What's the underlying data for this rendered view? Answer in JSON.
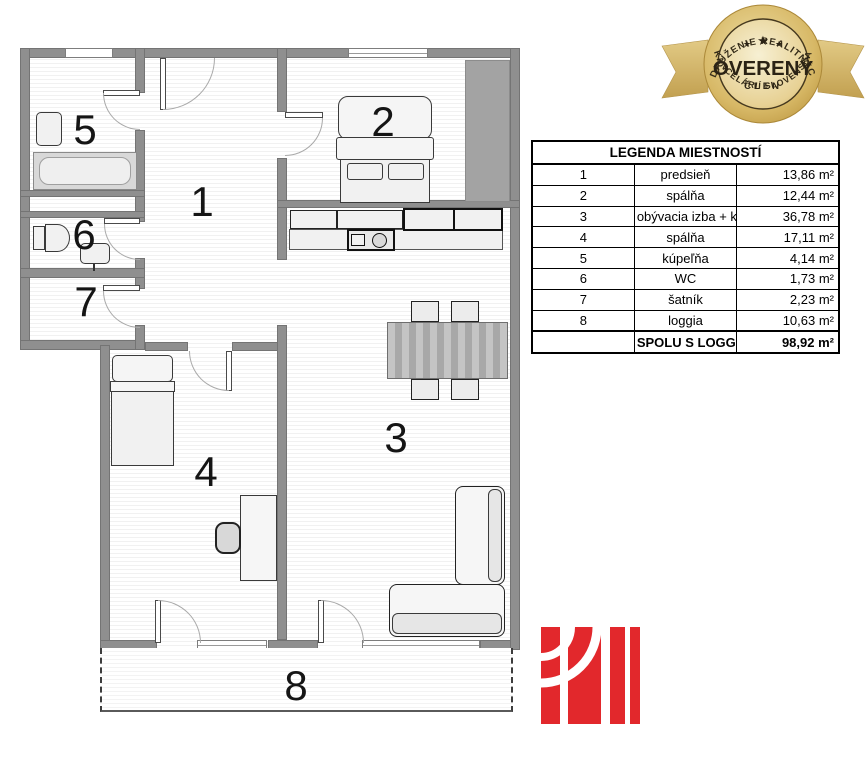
{
  "plan": {
    "rooms": [
      {
        "label": "1"
      },
      {
        "label": "2"
      },
      {
        "label": "3"
      },
      {
        "label": "4"
      },
      {
        "label": "5"
      },
      {
        "label": "6"
      },
      {
        "label": "7"
      },
      {
        "label": "8"
      }
    ]
  },
  "legend": {
    "title": "LEGENDA MIESTNOSTÍ",
    "rows": [
      {
        "num": "1",
        "name": "predsieň",
        "area": "13,86 m²"
      },
      {
        "num": "2",
        "name": "spálňa",
        "area": "12,44 m²"
      },
      {
        "num": "3",
        "name": "obývacia izba + kuchyňa",
        "area": "36,78 m²"
      },
      {
        "num": "4",
        "name": "spálňa",
        "area": "17,11 m²"
      },
      {
        "num": "5",
        "name": "kúpeľňa",
        "area": "4,14 m²"
      },
      {
        "num": "6",
        "name": "WC",
        "area": "1,73 m²"
      },
      {
        "num": "7",
        "name": "šatník",
        "area": "2,23 m²"
      },
      {
        "num": "8",
        "name": "loggia",
        "area": "10,63 m²"
      }
    ],
    "total_label": "SPOLU S LOGGIOU",
    "total_area": "98,92 m²"
  },
  "badge": {
    "arc_top": "ZDRUŽENIE REALITNÝCH",
    "arc_bottom": "KANCELÁRIÍ SLOVENSKA",
    "title": "OVERENÝ",
    "subtitle": "ČLEN",
    "star": "★"
  },
  "colors": {
    "accent_red": "#e2282c",
    "gold": "#c9a44e",
    "wall_gray": "#8f8f8f"
  }
}
